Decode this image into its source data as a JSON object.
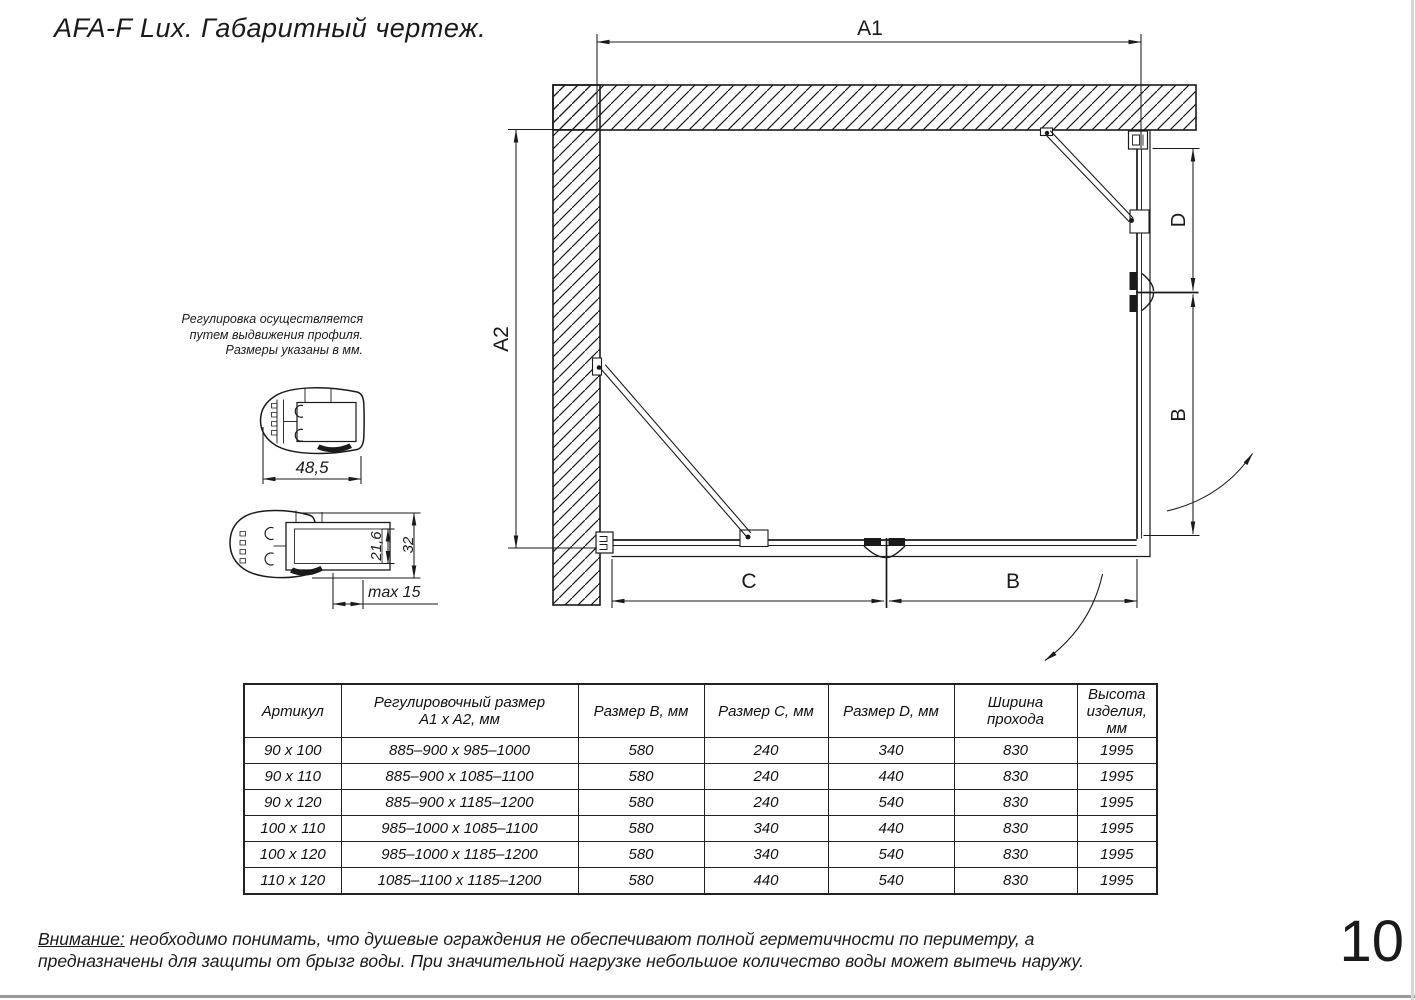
{
  "title": "AFA-F Lux. Габаритный чертеж.",
  "page_number": "10",
  "adjustment_note": {
    "lines": [
      "Регулировка осуществляется",
      "путем выдвижения профиля.",
      "Размеры указаны в мм."
    ]
  },
  "dims": {
    "a1": "A1",
    "a2": "A2",
    "d_side": "D",
    "b_side": "B",
    "c_front": "C",
    "b_front": "B",
    "profile_width": "48,5",
    "insert_height": "21,6",
    "profile_height": "32",
    "max_extension": "max 15"
  },
  "table": {
    "headers": [
      "Артикул",
      "Регулировочный размер\nA1 x A2, мм",
      "Размер B, мм",
      "Размер C, мм",
      "Размер D, мм",
      "Ширина\nпрохода",
      "Высота\nизделия,\nмм"
    ],
    "rows": [
      [
        "90 x 100",
        "885–900 x 985–1000",
        "580",
        "240",
        "340",
        "830",
        "1995"
      ],
      [
        "90 x 110",
        "885–900 x 1085–1100",
        "580",
        "240",
        "440",
        "830",
        "1995"
      ],
      [
        "90 x 120",
        "885–900 x 1185–1200",
        "580",
        "240",
        "540",
        "830",
        "1995"
      ],
      [
        "100 x 110",
        "985–1000 x 1085–1100",
        "580",
        "340",
        "440",
        "830",
        "1995"
      ],
      [
        "100 x 120",
        "985–1000 x 1185–1200",
        "580",
        "340",
        "540",
        "830",
        "1995"
      ],
      [
        "110 x 120",
        "1085–1100 x 1185–1200",
        "580",
        "440",
        "540",
        "830",
        "1995"
      ]
    ]
  },
  "warning": {
    "prefix": "Внимание:",
    "body": " необходимо понимать, что душевые ограждения не обеспечивают полной герметичности по периметру, а предназначены для защиты от брызг воды. При значительной нагрузке небольшое количество воды может вытечь наружу."
  },
  "line_color": "#1a1a1a"
}
